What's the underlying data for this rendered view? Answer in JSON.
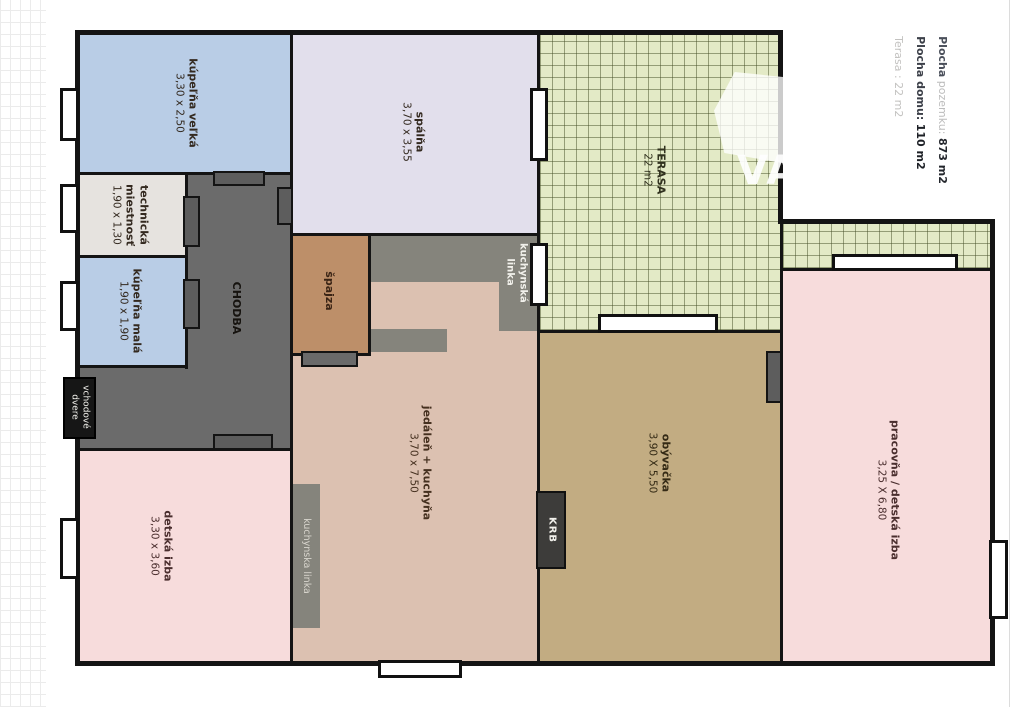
{
  "legend": {
    "line1_label": "Plocha",
    "line1_mid": "pozemku:",
    "line1_value": "873 m2",
    "line2_label": "Plocha domu:",
    "line2_value": "110 m2",
    "line3": "Terasa : 22 m2"
  },
  "watermark_text": "VA",
  "rooms": {
    "kupelna_velka": {
      "name": "kúpeľňa veľká",
      "dims": "3,30 x 2,50"
    },
    "technicka_miestnost": {
      "name": "technická miestnosť",
      "dims": "1,90 x 1,30"
    },
    "kupelna_mala": {
      "name": "kúpeľňa malá",
      "dims": "1,90 x 1,90"
    },
    "chodba": {
      "name": "CHODBA"
    },
    "spalna": {
      "name": "spálňa",
      "dims": "3,70 x 3,55"
    },
    "spajza": {
      "name": "špajza"
    },
    "jedalen_kuchyna": {
      "name": "jedáleň + kuchyňa",
      "dims": "3,70 x 7,50"
    },
    "terasa": {
      "name": "TERASA",
      "dims": "22 m2"
    },
    "obyvacka": {
      "name": "obývačka",
      "dims": "3,90 X 5,50"
    },
    "pracovna_detska": {
      "name": "pracovňa / detská izba",
      "dims": "3,25 X 6,80"
    },
    "detska_izba": {
      "name": "detská izba",
      "dims": "3,30 x 3,60"
    }
  },
  "features": {
    "kuchynska_linka_top": "kuchynská linka",
    "kuchynska_linka_left": "kuchynska linka",
    "krb": "KRB",
    "vchodove_dvere": "vchodové dvere"
  },
  "colors": {
    "wall": "#141414",
    "bathroom": "#b9cde6",
    "technical": "#e6e3df",
    "corridor": "#6b6b6b",
    "bedroom": "#e2dfec",
    "pantry": "#bd8f69",
    "dining": "#dcc1b1",
    "terrace": "#e3eac6",
    "living": "#c2ac82",
    "pink_room": "#f7dcdc"
  }
}
